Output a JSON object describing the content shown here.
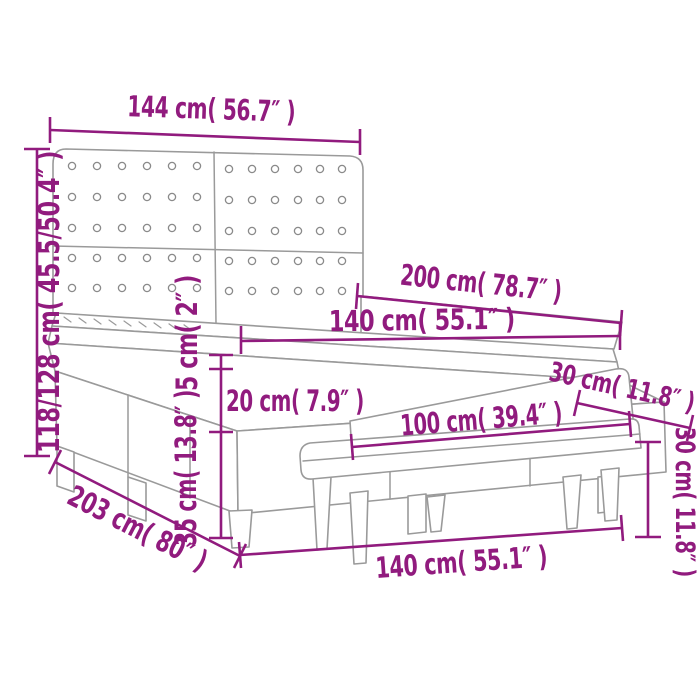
{
  "page": {
    "background": "#ffffff",
    "accent_color": "#911b7e",
    "line_color": "#9a9a9a",
    "description": "Dimension diagram of a box spring bed with button-tufted headboard, mattress and upholstered bench"
  },
  "diagram": {
    "type": "product-dimension-diagram",
    "labels": {
      "headboard_width": "144 cm( 56.7″ )",
      "headboard_height": "118/128 cm( 45.5/50.4″ )",
      "bed_length": "200 cm( 78.7″ )",
      "mattress_width": "140 cm( 55.1″ )",
      "topper_height": "5 cm( 2″ )",
      "mattress_height": "20 cm( 7.9″ )",
      "frame_height": "35 cm( 13.8″ )",
      "total_length": "203 cm( 80″ )",
      "bench_length": "100 cm( 39.4″ )",
      "bench_depth": "30 cm( 11.8″ )",
      "bench_height": "30 cm( 11.8″ )",
      "bed_width": "140 cm( 55.1″ )"
    },
    "values": {
      "headboard_width_cm": "144",
      "headboard_width_in": "56.7",
      "headboard_height_cm": "118/128",
      "headboard_height_in": "45.5/50.4",
      "bed_length_cm": "200",
      "bed_length_in": "78.7",
      "mattress_width_cm": "140",
      "mattress_width_in": "55.1",
      "topper_height_cm": "5",
      "topper_height_in": "2",
      "mattress_height_cm": "20",
      "mattress_height_in": "7.9",
      "frame_height_cm": "35",
      "frame_height_in": "13.8",
      "total_length_cm": "203",
      "total_length_in": "80",
      "bench_length_cm": "100",
      "bench_length_in": "39.4",
      "bench_depth_cm": "30",
      "bench_depth_in": "11.8",
      "bench_height_cm": "30",
      "bench_height_in": "11.8",
      "bed_width_cm": "140",
      "bed_width_in": "55.1"
    }
  }
}
